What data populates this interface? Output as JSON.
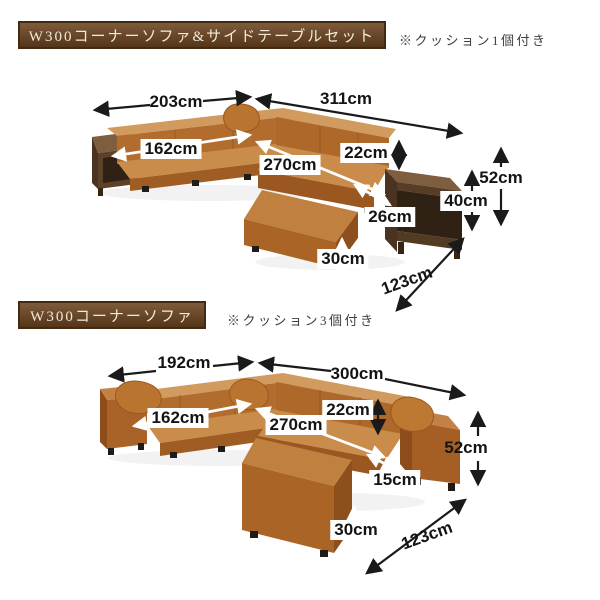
{
  "sections": [
    {
      "title": "W300コーナーソファ&サイドテーブルセット",
      "note": "※クッション1個付き",
      "measurements": {
        "back_width": "203cm",
        "side_width": "311cm",
        "seat_width": "162cm",
        "seat_length": "270cm",
        "backrest_height": "22cm",
        "total_height": "52cm",
        "table_height": "40cm",
        "table_top_depth": "26cm",
        "seat_height": "30cm",
        "chaise_depth": "123cm"
      }
    },
    {
      "title": "W300コーナーソファ",
      "note": "※クッション3個付き",
      "measurements": {
        "back_width": "192cm",
        "side_width": "300cm",
        "seat_width": "162cm",
        "seat_length": "270cm",
        "backrest_height": "22cm",
        "total_height": "52cm",
        "armrest_width": "15cm",
        "seat_height": "30cm",
        "chaise_depth": "123cm"
      }
    }
  ],
  "colors": {
    "leather_main": "#b26d2e",
    "leather_light": "#d19a5e",
    "leather_seat": "#c98c4b",
    "leather_dark": "#8d4e1b",
    "wood_top": "#7d5e3e",
    "wood_front": "#5d4128",
    "header_brown": "#6b4a2c",
    "label_background": "#ffffff",
    "arrow_black": "#1a1a1a",
    "arrow_white": "#ffffff"
  }
}
